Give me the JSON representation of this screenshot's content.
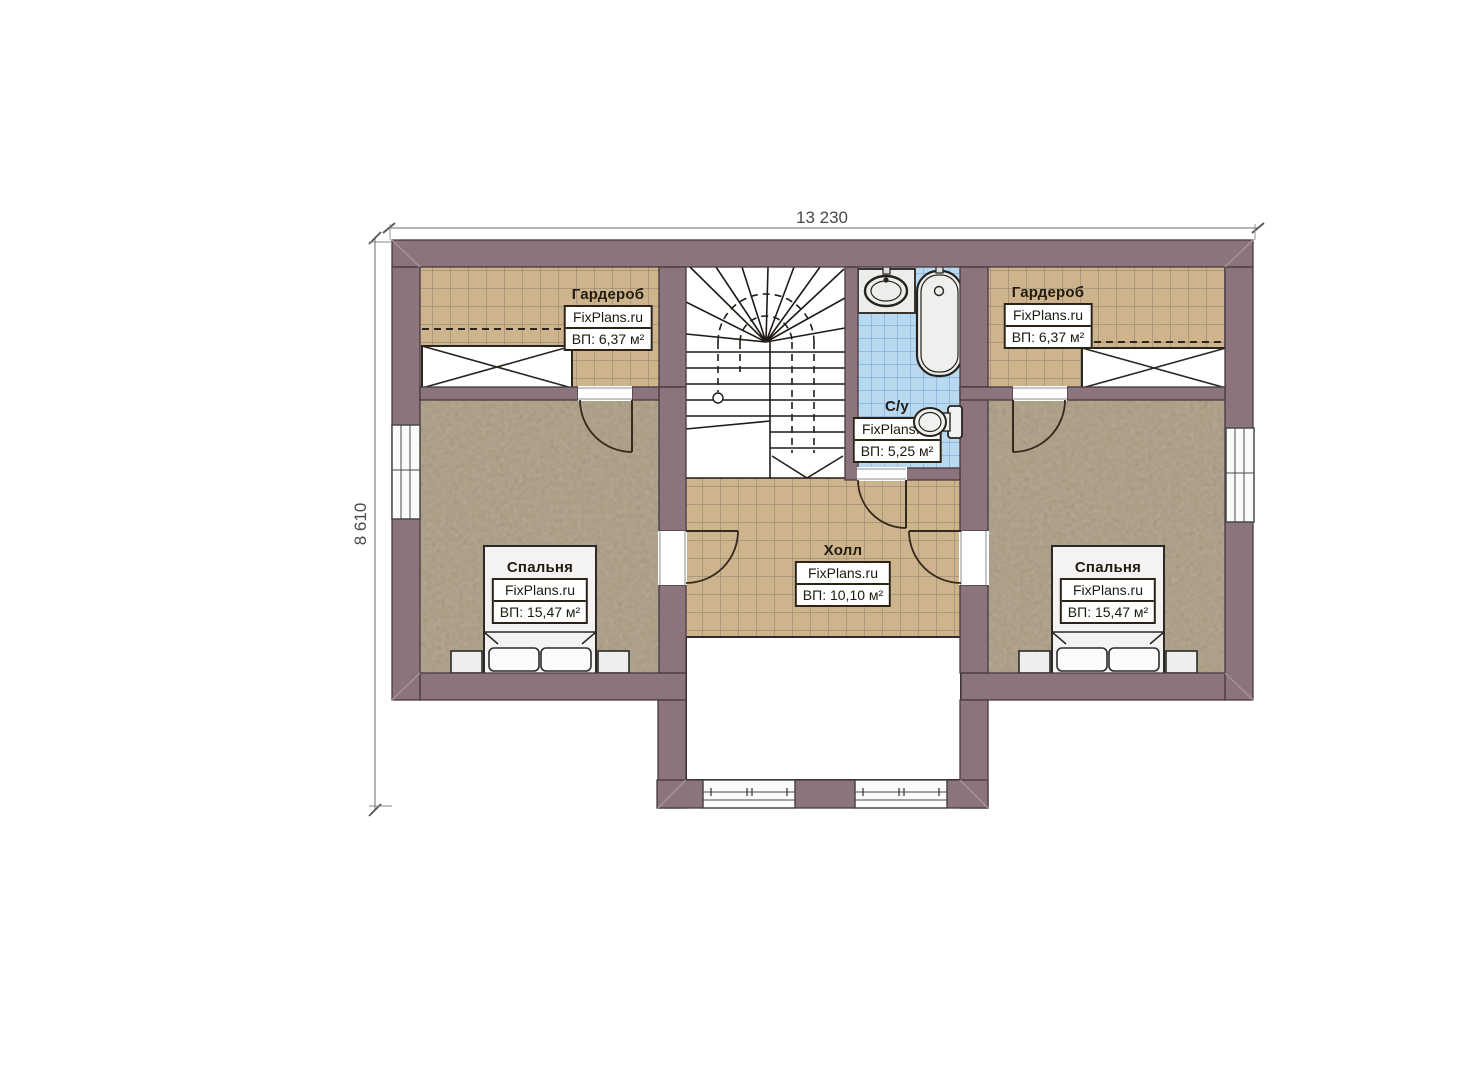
{
  "dimensions": {
    "width": "13 230",
    "height": "8 610"
  },
  "rooms": {
    "wardrobe_left": {
      "name": "Гардероб",
      "brand": "FixPlans.ru",
      "area": "ВП: 6,37 м²"
    },
    "wardrobe_right": {
      "name": "Гардероб",
      "brand": "FixPlans.ru",
      "area": "ВП: 6,37 м²"
    },
    "bathroom": {
      "name": "С/у",
      "brand": "FixPlans.ru",
      "area": "ВП: 5,25 м²"
    },
    "hall": {
      "name": "Холл",
      "brand": "FixPlans.ru",
      "area": "ВП: 10,10 м²"
    },
    "bedroom_left": {
      "name": "Спальня",
      "brand": "FixPlans.ru",
      "area": "ВП: 15,47 м²"
    },
    "bedroom_right": {
      "name": "Спальня",
      "brand": "FixPlans.ru",
      "area": "ВП: 15,47 м²"
    }
  },
  "colors": {
    "wall": "#8b747b",
    "floor_tile_tan": "#cdb48c",
    "floor_tile_blue": "#b9d9f1",
    "floor_carpet": "#8e7c61",
    "fixture_fill": "#ededeb",
    "outline": "#2b2315"
  }
}
